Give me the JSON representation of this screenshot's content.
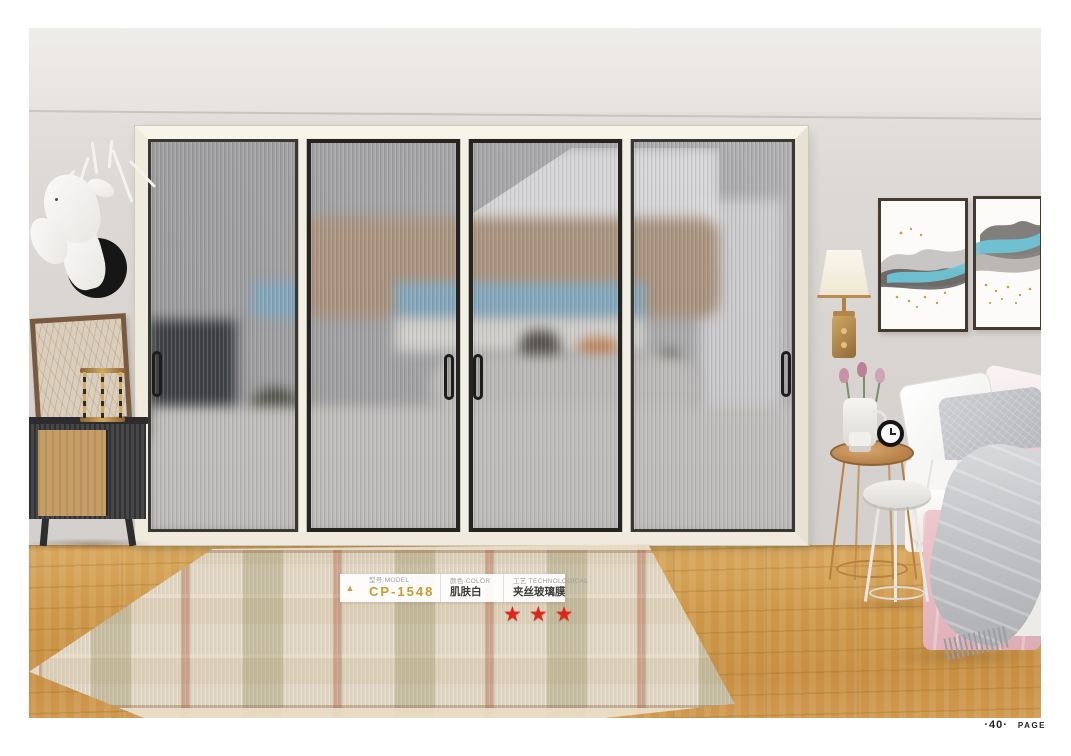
{
  "page": {
    "number": "·40·",
    "page_label": "PAGE"
  },
  "product": {
    "marker_glyph": "▲",
    "model": {
      "label": "型号 MODEL",
      "value": "CP-1548"
    },
    "color": {
      "label": "颜色 COLOR",
      "value": "肌肤白"
    },
    "technique": {
      "label": "工艺 TECHNOLOGICAL",
      "value": "夹丝玻璃膜"
    },
    "rating": 3,
    "stars_text": "★★★"
  },
  "theme": {
    "accent_gold": "#c9992e",
    "star_red": "#e02418",
    "label_gray": "#9d9d9d",
    "value_dark": "#3a3a3a",
    "wall_gray": "#d6d2cf",
    "floor_wood": "#cf9c52",
    "door_frame_cream": "#f1eee4"
  }
}
